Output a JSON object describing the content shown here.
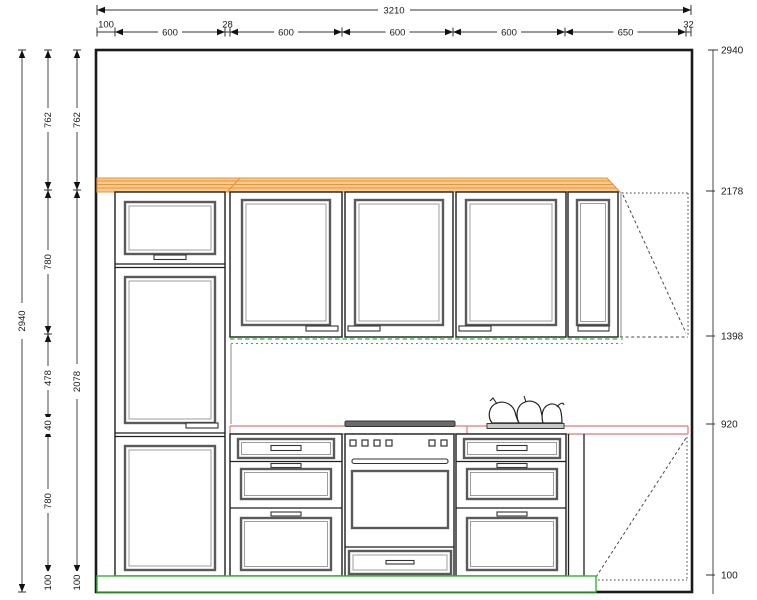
{
  "drawing": {
    "title": "kitchen-elevation",
    "dims": {
      "top_overall": "3210",
      "top_segments": [
        "100",
        "600",
        "28",
        "600",
        "600",
        "600",
        "650",
        "32"
      ],
      "left_total": "2940",
      "left_col2": [
        "762",
        "780",
        "478",
        "40",
        "780",
        "100"
      ],
      "left_col3": [
        "762",
        "2078",
        "100"
      ],
      "right_levels": [
        "2940",
        "2178",
        "1398",
        "920",
        "100"
      ]
    },
    "colors": {
      "cornice_fill": "#f8c98c",
      "cornice_line": "#e6953c",
      "worktop_red": "#e07878",
      "plinth_green": "#2eb82e",
      "hob_gray": "#6b6b6b",
      "tray_gray": "#c9c9c9"
    }
  }
}
